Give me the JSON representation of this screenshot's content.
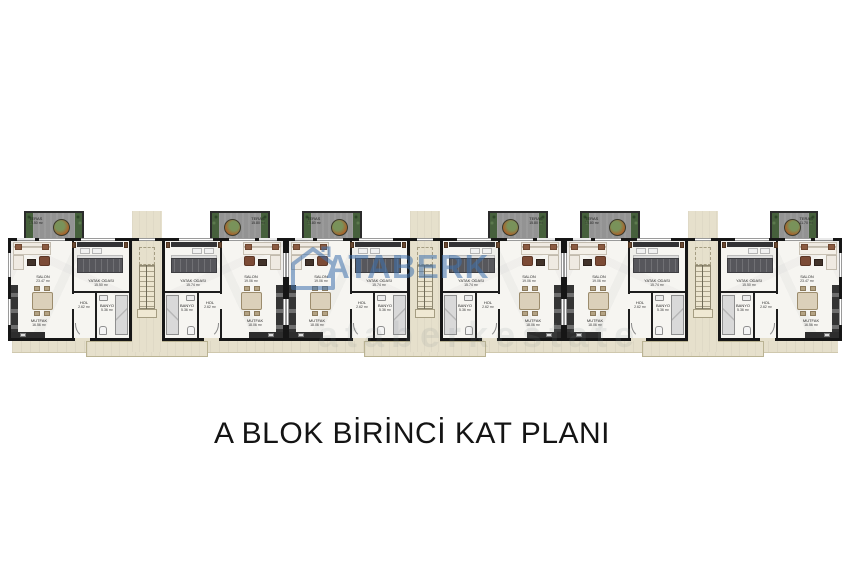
{
  "title": "A BLOK BİRİNCİ KAT PLANI",
  "watermark": {
    "brand": "ATABERK",
    "logo_icon": "house-outline-icon",
    "accent_color": "#3f72ae",
    "faint_text": "ataberkestate"
  },
  "plan": {
    "block": "A",
    "floor": "BİRİNCİ KAT",
    "stairwell_count": 3,
    "units": [
      {
        "id": "A1",
        "orientation": "left",
        "variant": "standard",
        "rooms": {
          "teras": {
            "name": "TERAS",
            "area": "15.50 m²"
          },
          "salon": {
            "name": "SALON",
            "area": "23.47 m²"
          },
          "yatak": {
            "name": "YATAK ODASI",
            "area": "15.50 m²"
          },
          "hol": {
            "name": "HOL",
            "area": "2.62 m²"
          },
          "banyo": {
            "name": "BANYO",
            "area": "5.36 m²"
          },
          "mutfak": {
            "name": "MUTFAK",
            "area": "16.56 m²"
          }
        }
      },
      {
        "id": "A2",
        "orientation": "right",
        "variant": "standard",
        "rooms": {
          "teras": {
            "name": "TERAS",
            "area": "15.80 m²"
          },
          "salon": {
            "name": "SALON",
            "area": "19.06 m²"
          },
          "yatak": {
            "name": "YATAK ODASI",
            "area": "15.74 m²"
          },
          "hol": {
            "name": "HOL",
            "area": "2.62 m²"
          },
          "banyo": {
            "name": "BANYO",
            "area": "5.36 m²"
          },
          "mutfak": {
            "name": "MUTFAK",
            "area": "18.06 m²"
          }
        }
      },
      {
        "id": "A3",
        "orientation": "left",
        "variant": "standard",
        "rooms": {
          "teras": {
            "name": "TERAS",
            "area": "15.80 m²"
          },
          "salon": {
            "name": "SALON",
            "area": "19.06 m²"
          },
          "yatak": {
            "name": "YATAK ODASI",
            "area": "15.74 m²"
          },
          "hol": {
            "name": "HOL",
            "area": "2.62 m²"
          },
          "banyo": {
            "name": "BANYO",
            "area": "5.36 m²"
          },
          "mutfak": {
            "name": "MUTFAK",
            "area": "18.06 m²"
          }
        }
      },
      {
        "id": "A4",
        "orientation": "right",
        "variant": "standard",
        "rooms": {
          "teras": {
            "name": "TERAS",
            "area": "15.80 m²"
          },
          "salon": {
            "name": "SALON",
            "area": "19.06 m²"
          },
          "yatak": {
            "name": "YATAK ODASI",
            "area": "15.74 m²"
          },
          "hol": {
            "name": "HOL",
            "area": "2.62 m²"
          },
          "banyo": {
            "name": "BANYO",
            "area": "5.36 m²"
          },
          "mutfak": {
            "name": "MUTFAK",
            "area": "18.06 m²"
          }
        }
      },
      {
        "id": "A5",
        "orientation": "left",
        "variant": "standard",
        "rooms": {
          "teras": {
            "name": "TERAS",
            "area": "15.80 m²"
          },
          "salon": {
            "name": "SALON",
            "area": "19.06 m²"
          },
          "yatak": {
            "name": "YATAK ODASI",
            "area": "15.74 m²"
          },
          "hol": {
            "name": "HOL",
            "area": "2.62 m²"
          },
          "banyo": {
            "name": "BANYO",
            "area": "5.36 m²"
          },
          "mutfak": {
            "name": "MUTFAK",
            "area": "18.06 m²"
          }
        }
      },
      {
        "id": "A6",
        "orientation": "right",
        "variant": "narrow",
        "rooms": {
          "teras": {
            "name": "TERAS",
            "area": "11.70 m²"
          },
          "salon": {
            "name": "SALON",
            "area": "23.47 m²"
          },
          "yatak": {
            "name": "YATAK ODASI",
            "area": "15.50 m²"
          },
          "hol": {
            "name": "HOL",
            "area": "2.62 m²"
          },
          "banyo": {
            "name": "BANYO",
            "area": "5.36 m²"
          },
          "mutfak": {
            "name": "MUTFAK",
            "area": "16.56 m²"
          }
        }
      }
    ]
  },
  "colors": {
    "wall": "#161616",
    "floor": "#f6f5f1",
    "terrace": "#939393",
    "plants": "#46603c",
    "walkway": "#e5dfcb",
    "wood": "#8a5a40",
    "watermark_blue": "#3f72ae"
  }
}
